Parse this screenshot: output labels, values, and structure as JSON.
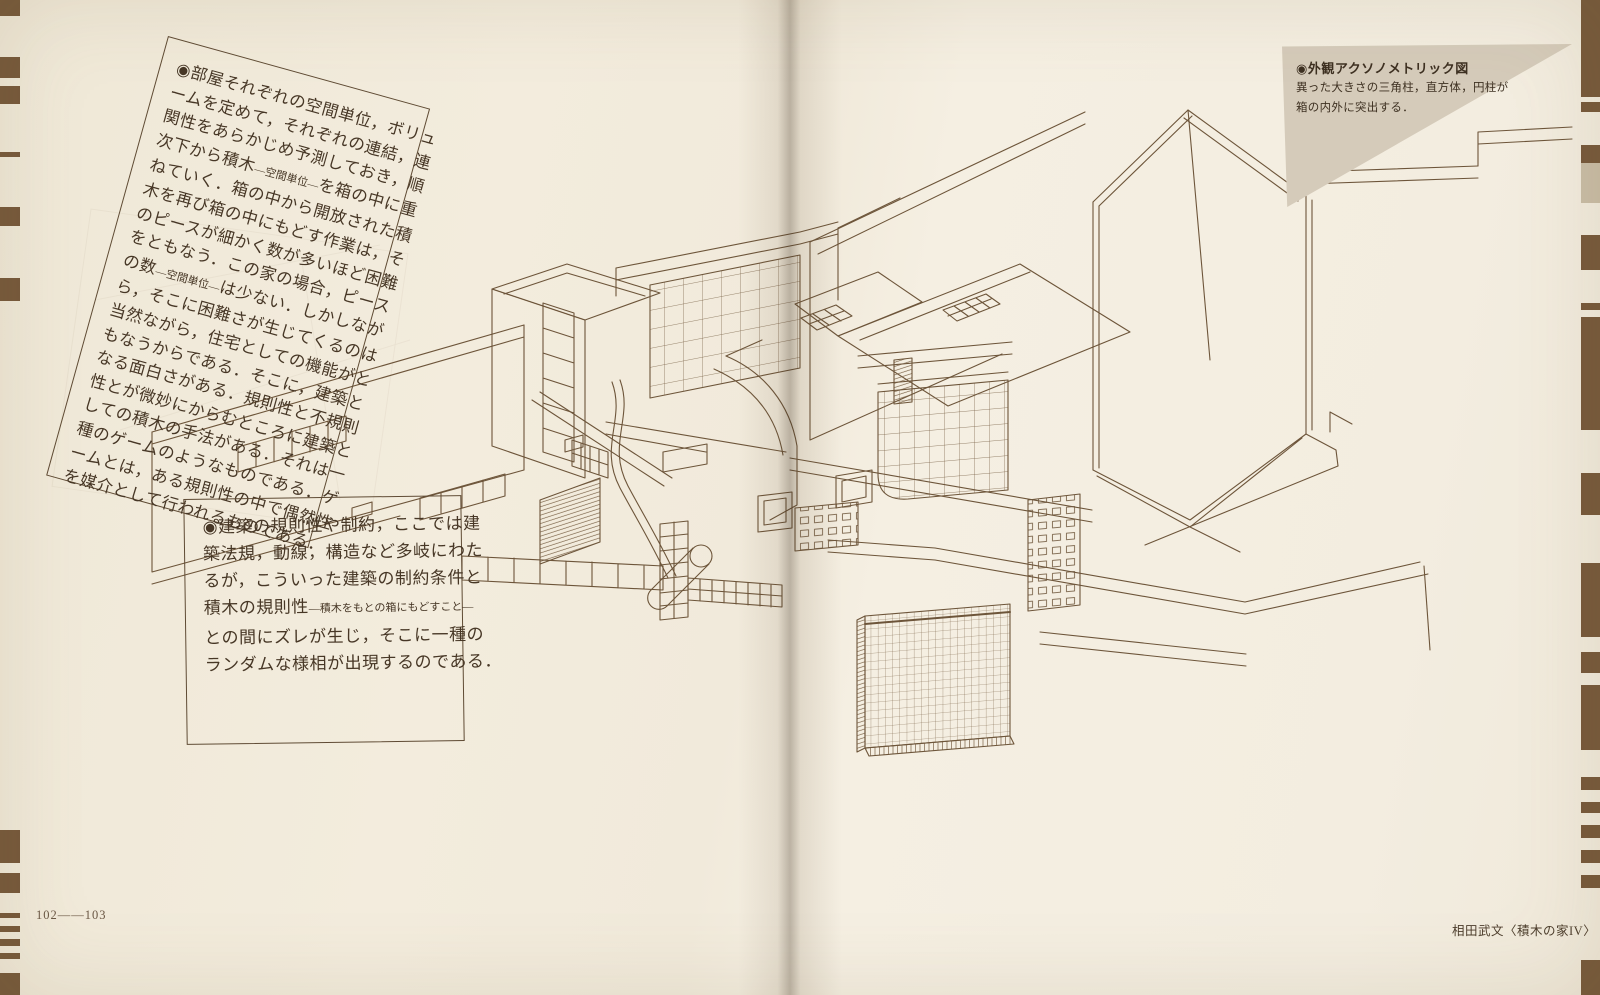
{
  "annotations": {
    "block1": {
      "lines": [
        [
          {
            "t": "◉部屋それぞれの空間単位，ボリュ"
          }
        ],
        [
          {
            "t": "ームを定めて，それぞれの連結，連"
          }
        ],
        [
          {
            "t": "関性をあらかじめ予測しておき，順"
          }
        ],
        [
          {
            "t": "次下から積木"
          },
          {
            "t": "―空間単位―",
            "sm": true
          },
          {
            "t": "を箱の中に重"
          }
        ],
        [
          {
            "t": "ねていく．箱の中から開放された積"
          }
        ],
        [
          {
            "t": "木を再び箱の中にもどす作業は，そ"
          }
        ],
        [
          {
            "t": "のピースが細かく数が多いほど困難"
          }
        ],
        [
          {
            "t": "をともなう．この家の場合，ピース"
          }
        ],
        [
          {
            "t": "の数"
          },
          {
            "t": "―空間単位―",
            "sm": true
          },
          {
            "t": "は少ない．しかしなが"
          }
        ],
        [
          {
            "t": "ら，そこに困難さが生じてくるのは"
          }
        ],
        [
          {
            "t": "当然ながら，住宅としての機能がと"
          }
        ],
        [
          {
            "t": "もなうからである．そこに，建築と"
          }
        ],
        [
          {
            "t": "なる面白さがある．規則性と不規則"
          }
        ],
        [
          {
            "t": "性とが微妙にからむところに建築と"
          }
        ],
        [
          {
            "t": "しての積木の手法がある．それは一"
          }
        ],
        [
          {
            "t": "種のゲームのようなものである．ゲ"
          }
        ],
        [
          {
            "t": "ームとは，ある規則性の中で偶然性"
          }
        ],
        [
          {
            "t": "を媒介として行われるものである．"
          }
        ]
      ]
    },
    "block2": {
      "lines": [
        [
          {
            "t": "◉建築の規則性や制約，ここでは建"
          }
        ],
        [
          {
            "t": "築法規，動線，構造など多岐にわた"
          }
        ],
        [
          {
            "t": "るが，こういった建築の制約条件と"
          }
        ],
        [
          {
            "t": "積木の規則性"
          },
          {
            "t": "―積木をもとの箱にもどすこと―",
            "sm": true
          }
        ],
        [
          {
            "t": "との間にズレが生じ，そこに一種の"
          }
        ],
        [
          {
            "t": "ランダムな様相が出現するのである．"
          }
        ]
      ]
    },
    "figure_caption": {
      "title": "◉外観アクソノメトリック図",
      "lines": [
        [
          {
            "t": "異った大きさの三角柱，直方体，円柱が"
          }
        ],
        [
          {
            "t": "箱の内外に突出する．"
          }
        ]
      ]
    }
  },
  "footer": {
    "page_numbers": "102——103",
    "credit": "相田武文〈積木の家IV〉"
  },
  "colors": {
    "paper": "#f2ebdc",
    "drawing_line": "#6d553a",
    "body_text": "#473726",
    "caption_triangle": "#d5cbba",
    "edge_stripe": "#76593b",
    "edge_stripe_light": "#c9bda6"
  },
  "edge_stripes": {
    "left": [
      {
        "y": 0,
        "h": 16
      },
      {
        "y": 57,
        "h": 21
      },
      {
        "y": 86,
        "h": 18
      },
      {
        "y": 152,
        "h": 5
      },
      {
        "y": 207,
        "h": 19
      },
      {
        "y": 278,
        "h": 23
      },
      {
        "y": 830,
        "h": 33
      },
      {
        "y": 873,
        "h": 20
      },
      {
        "y": 913,
        "h": 5
      },
      {
        "y": 926,
        "h": 6
      },
      {
        "y": 939,
        "h": 7
      },
      {
        "y": 953,
        "h": 6
      },
      {
        "y": 973,
        "h": 22
      }
    ],
    "right": [
      {
        "y": 0,
        "h": 97
      },
      {
        "y": 102,
        "h": 10
      },
      {
        "y": 145,
        "h": 18
      },
      {
        "y": 163,
        "h": 40,
        "light": true
      },
      {
        "y": 235,
        "h": 35
      },
      {
        "y": 303,
        "h": 7
      },
      {
        "y": 317,
        "h": 113
      },
      {
        "y": 473,
        "h": 42
      },
      {
        "y": 563,
        "h": 74
      },
      {
        "y": 652,
        "h": 21
      },
      {
        "y": 685,
        "h": 65
      },
      {
        "y": 777,
        "h": 13
      },
      {
        "y": 802,
        "h": 11
      },
      {
        "y": 825,
        "h": 13
      },
      {
        "y": 850,
        "h": 13
      },
      {
        "y": 875,
        "h": 13
      },
      {
        "y": 960,
        "h": 35
      }
    ]
  }
}
